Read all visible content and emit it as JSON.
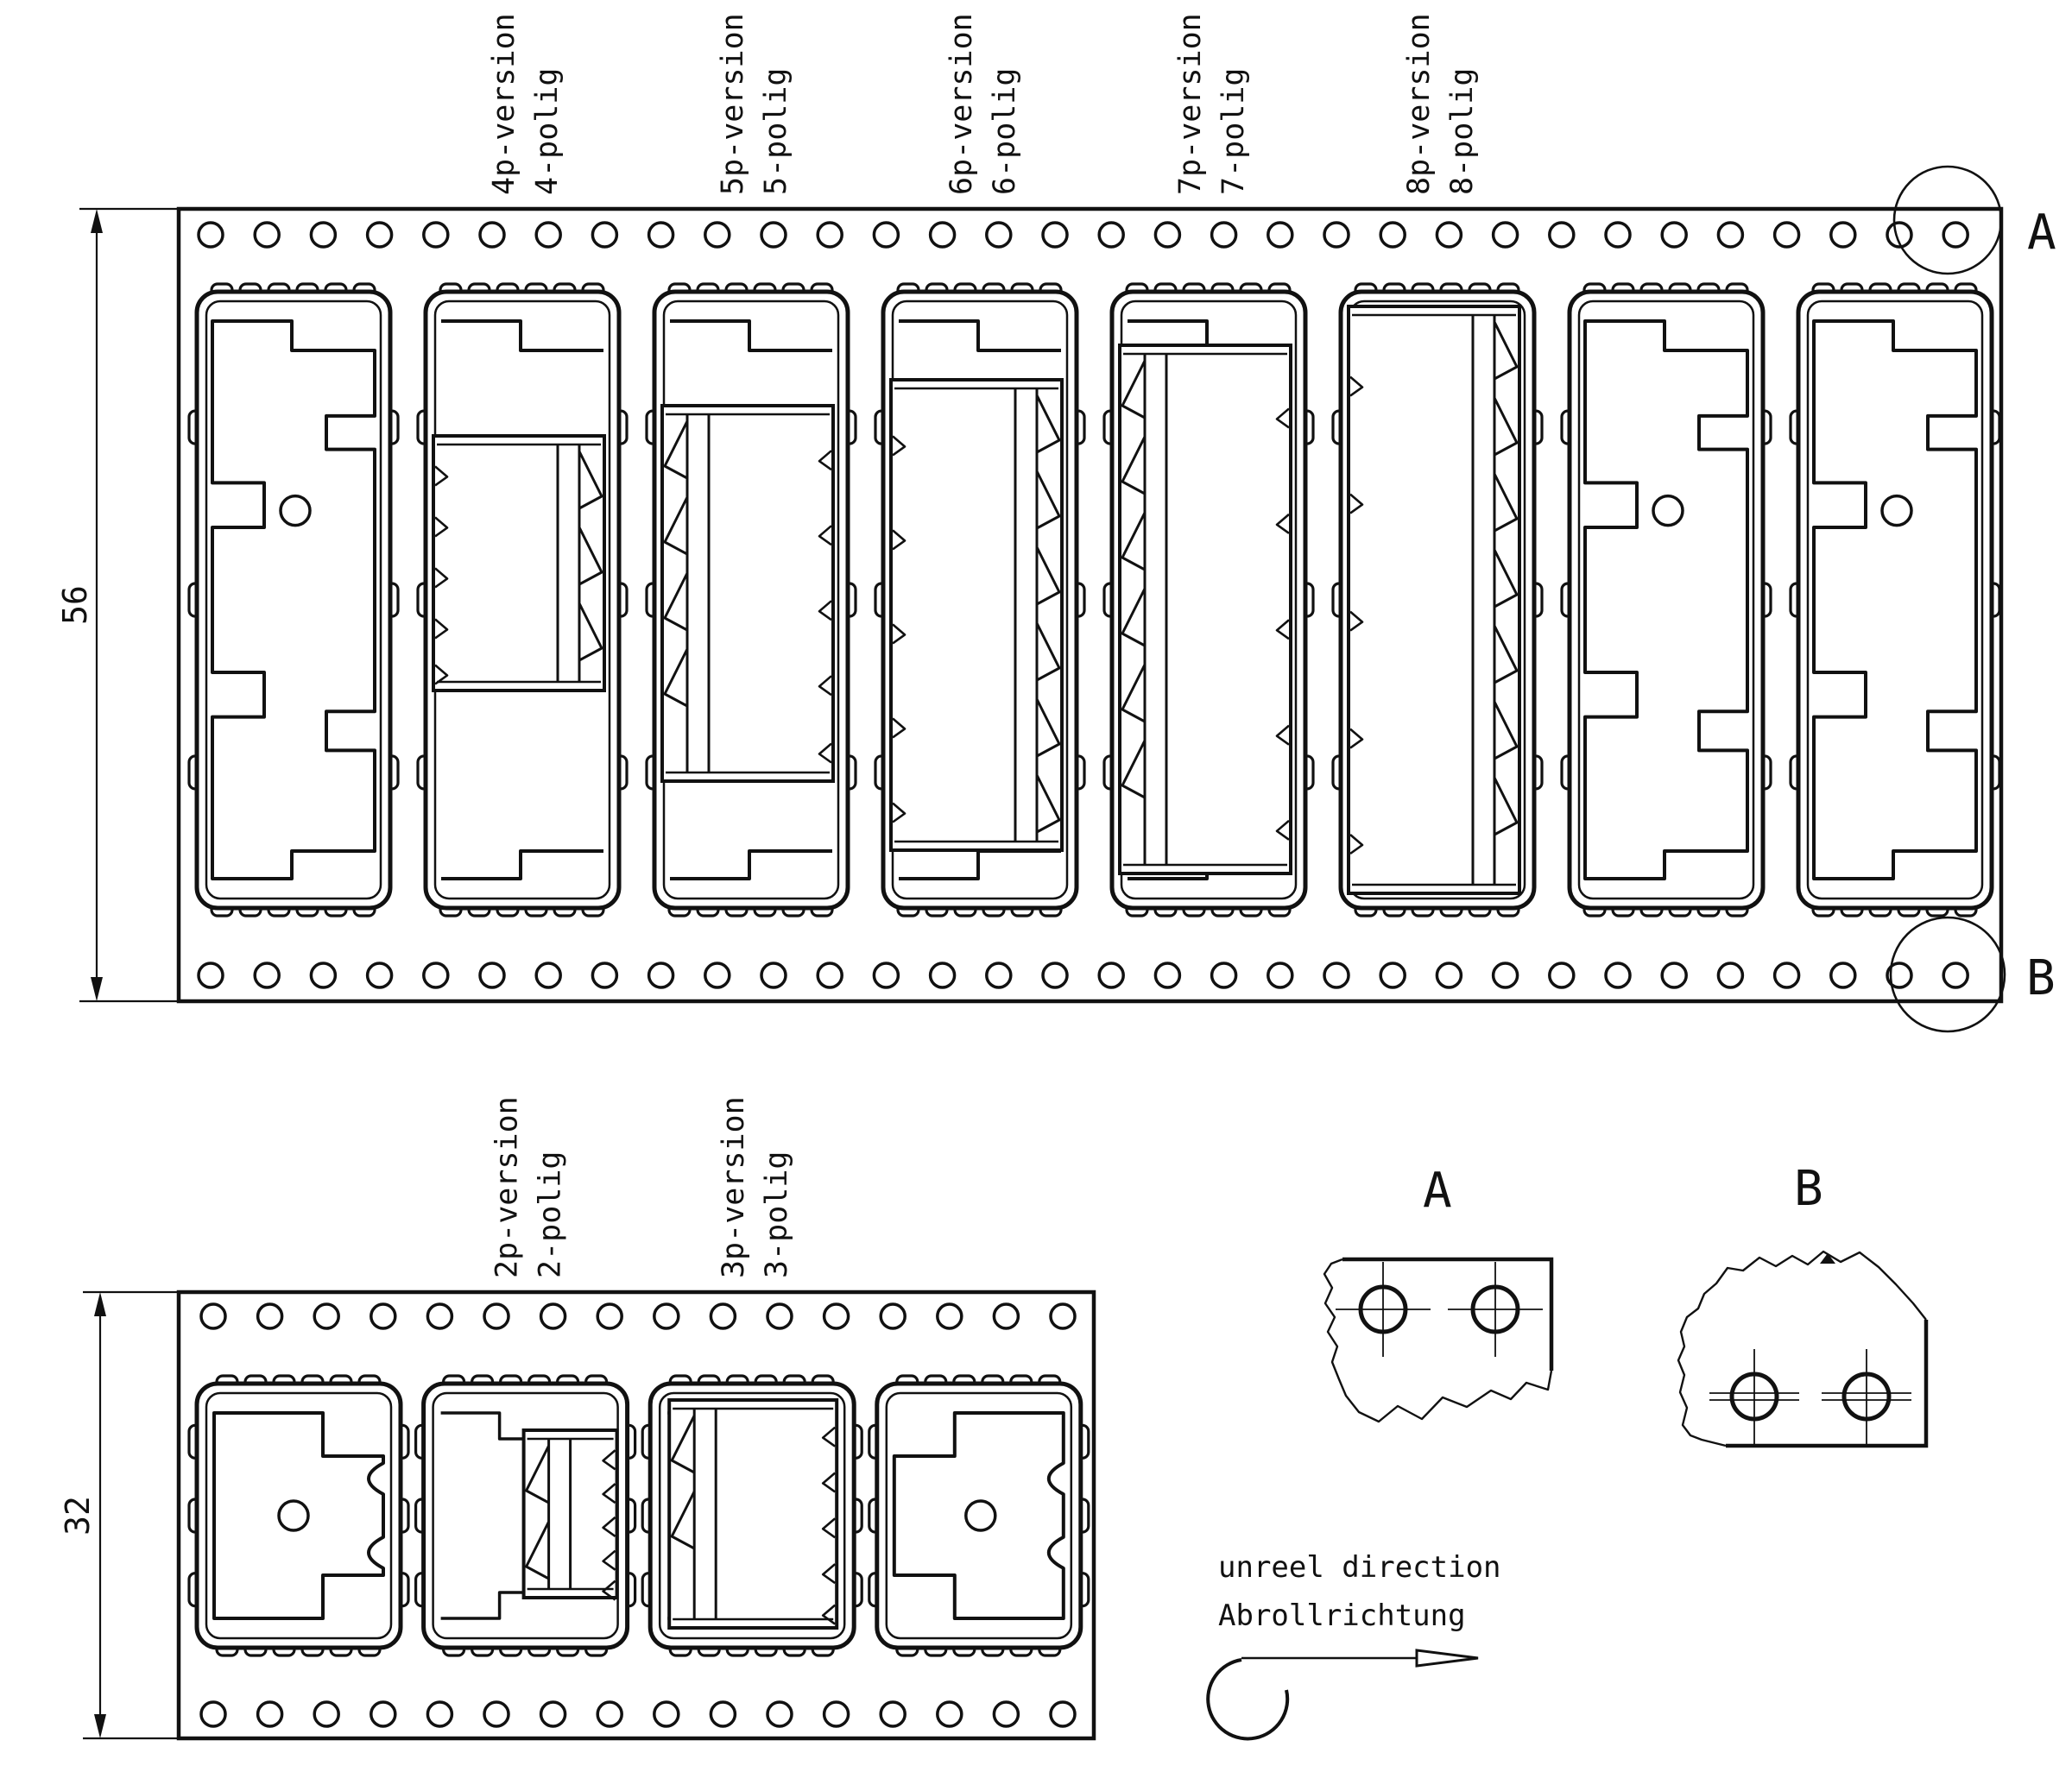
{
  "drawing": {
    "title": "connector carrier tape drawing",
    "background": "#ffffff",
    "line_color": "#111111",
    "top_tape": {
      "width_dim": "56",
      "holes_per_row": 32,
      "pockets": [
        "empty",
        "4p",
        "5p",
        "6p",
        "7p",
        "8p",
        "empty",
        "empty"
      ],
      "labels": [
        {
          "pocket": 1,
          "line1": "4p-version",
          "line2": "4-polig"
        },
        {
          "pocket": 2,
          "line1": "5p-version",
          "line2": "5-polig"
        },
        {
          "pocket": 3,
          "line1": "6p-version",
          "line2": "6-polig"
        },
        {
          "pocket": 4,
          "line1": "7p-version",
          "line2": "7-polig"
        },
        {
          "pocket": 5,
          "line1": "8p-version",
          "line2": "8-polig"
        }
      ],
      "marker_a": "A",
      "marker_b": "B"
    },
    "bottom_tape": {
      "width_dim": "32",
      "holes_per_row": 16,
      "pockets": [
        "empty-left",
        "2p",
        "3p",
        "empty-right"
      ],
      "labels": [
        {
          "pocket": 1,
          "line1": "2p-version",
          "line2": "2-polig"
        },
        {
          "pocket": 2,
          "line1": "3p-version",
          "line2": "3-polig"
        }
      ]
    },
    "detail_views": {
      "a": {
        "title": "A"
      },
      "b": {
        "title": "B"
      }
    },
    "unreel": {
      "line1": "unreel direction",
      "line2": "Abrollrichtung"
    }
  }
}
